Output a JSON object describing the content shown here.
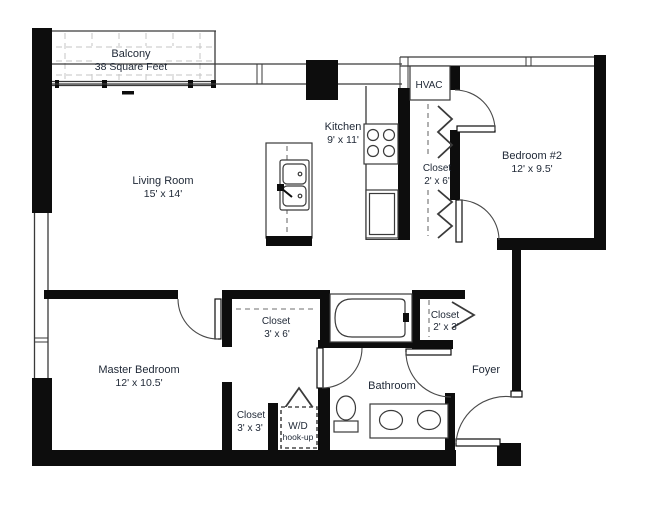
{
  "colors": {
    "wall": "#0d0d0d",
    "label_text": "#212a38",
    "tile_dash": "#c4c4c4",
    "background": "#ffffff"
  },
  "rooms": {
    "balcony": {
      "name": "Balcony",
      "area": "38 Square Feet"
    },
    "living_room": {
      "name": "Living Room",
      "dims": "15' x 14'"
    },
    "kitchen": {
      "name": "Kitchen",
      "dims": "9' x 11'"
    },
    "hvac": {
      "name": "HVAC"
    },
    "bedroom2": {
      "name": "Bedroom #2",
      "dims": "12' x 9.5'"
    },
    "closet_bedroom2": {
      "name": "Closet",
      "dims": "2' x 6'"
    },
    "master_bedroom": {
      "name": "Master Bedroom",
      "dims": "12' x 10.5'"
    },
    "closet_hall": {
      "name": "Closet",
      "dims": "3' x 6'"
    },
    "closet_foyer": {
      "name": "Closet",
      "dims": "2' x 3'"
    },
    "closet_master": {
      "name": "Closet",
      "dims": "3' x 3'"
    },
    "laundry": {
      "name": "W/D",
      "dims": "hook-up"
    },
    "bathroom": {
      "name": "Bathroom"
    },
    "foyer": {
      "name": "Foyer"
    }
  },
  "fixtures": [
    "bathtub",
    "toilet",
    "double-vanity-sinks",
    "island-double-sink",
    "range-burners",
    "refrigerator",
    "hvac-unit",
    "washer-dryer-hookup",
    "balcony-tile",
    "entry-door"
  ]
}
